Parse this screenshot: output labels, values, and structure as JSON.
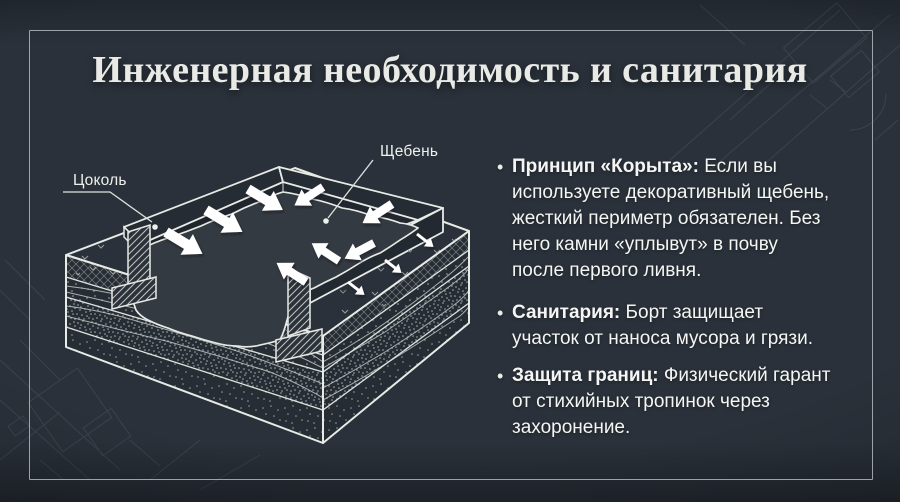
{
  "slide": {
    "title": "Инженерная необходимость и санитария",
    "bullet_char": "•",
    "bullets": [
      {
        "lead": "Принцип «Корыта»:",
        "text": "Если вы используете декоративный щебень, жесткий периметр обязателен. Без него камни «уплывут» в почву после первого ливня."
      },
      {
        "lead": "Санитария:",
        "text": "Борт защищает участок от наноса мусора и грязи."
      },
      {
        "lead": "Защита границ:",
        "text": "Физический гарант от стихийных тропинок через захоронение."
      }
    ],
    "diagram": {
      "labels": {
        "plinth": "Цоколь",
        "gravel": "Щебень"
      }
    },
    "colors": {
      "background": "#2a313a",
      "frame_border": "#bcc2c7",
      "title_text": "#e9eae6",
      "body_text": "#f5f6f4",
      "line_art": "#e8eae6",
      "arrow": "#ffffff"
    }
  }
}
